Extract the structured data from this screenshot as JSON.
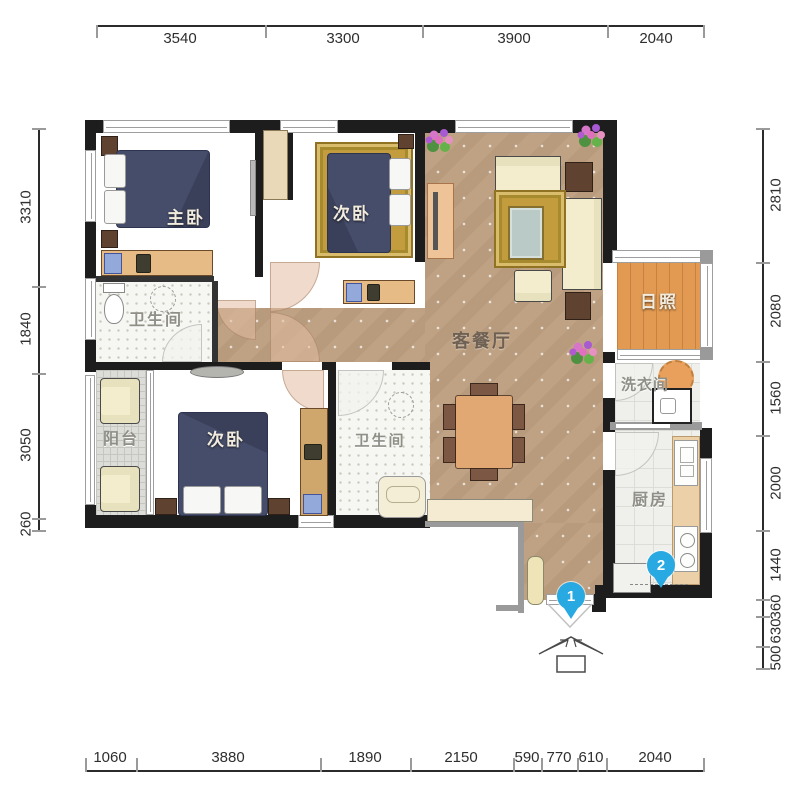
{
  "plan": {
    "rooms": [
      {
        "id": "master-bedroom",
        "label": "主卧"
      },
      {
        "id": "bedroom2-top",
        "label": "次卧"
      },
      {
        "id": "bathroom1",
        "label": "卫生间"
      },
      {
        "id": "living-dining",
        "label": "客餐厅"
      },
      {
        "id": "sunroom",
        "label": "日照"
      },
      {
        "id": "laundry",
        "label": "洗衣间"
      },
      {
        "id": "kitchen",
        "label": "厨房"
      },
      {
        "id": "balcony",
        "label": "阳台"
      },
      {
        "id": "bedroom2-bottom",
        "label": "次卧"
      },
      {
        "id": "bathroom2",
        "label": "卫生间"
      }
    ],
    "markers": [
      {
        "number": "1"
      },
      {
        "number": "2"
      }
    ]
  },
  "dimensions": {
    "top": [
      "3540",
      "3300",
      "3900",
      "2040"
    ],
    "bottom": [
      "1060",
      "3880",
      "1890",
      "2150",
      "590",
      "770",
      "610",
      "2040"
    ],
    "left": [
      "3310",
      "1840",
      "3050",
      "260"
    ],
    "right": [
      "2810",
      "2080",
      "1560",
      "2000",
      "1440",
      "360",
      "630",
      "500"
    ]
  },
  "colors": {
    "marker_blue": "#29a9e1",
    "wall": "#1d1d1d",
    "bedroom_wood": "#87401c",
    "living_marble": "#c2a687",
    "sunroom_wood": "#e29a52",
    "rug_gold": "#c39c3e",
    "bed_navy": "#464d6a"
  }
}
